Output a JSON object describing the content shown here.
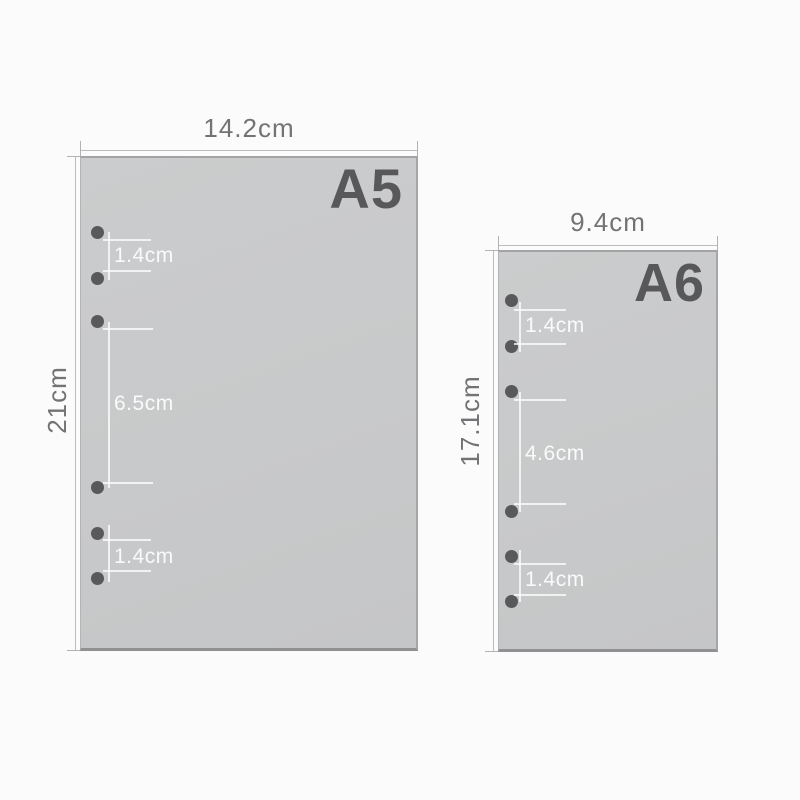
{
  "sheets": [
    {
      "size_label": "A5",
      "width": "14.2cm",
      "height": "21cm",
      "hole_count": 6,
      "hole_spacings": [
        "1.4cm",
        "6.5cm",
        "1.4cm"
      ]
    },
    {
      "size_label": "A6",
      "width": "9.4cm",
      "height": "17.1cm",
      "hole_count": 6,
      "hole_spacings": [
        "1.4cm",
        "4.6cm",
        "1.4cm"
      ]
    }
  ],
  "colors": {
    "page_background": "#fbfbfb",
    "sheet_fill": "#c8c9ca",
    "sheet_border": "#9b9b9d",
    "hole": "#59595b",
    "size_label_text": "#58585a",
    "dimension_text": "#737375",
    "dimension_line": "#bcbcbc",
    "annotation_line": "#ffffff",
    "annotation_text": "#fafafa"
  }
}
